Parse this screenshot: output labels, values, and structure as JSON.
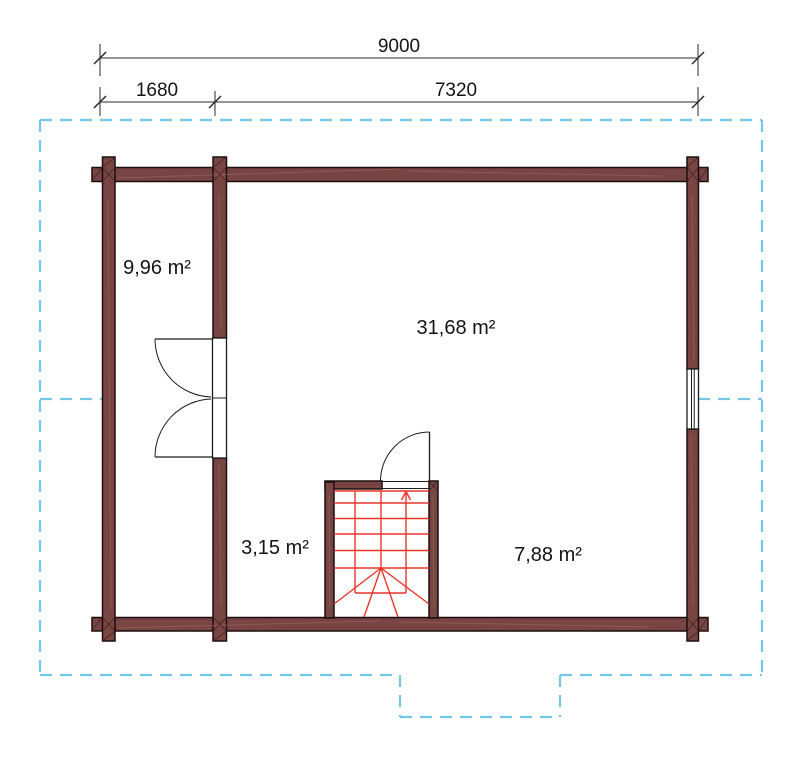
{
  "dimensions": {
    "total": "9000",
    "segment_left": "1680",
    "segment_right": "7320"
  },
  "rooms": [
    {
      "id": "room-left",
      "label": "9,96 m²"
    },
    {
      "id": "room-main",
      "label": "31,68 m²"
    },
    {
      "id": "room-hall",
      "label": "3,15 m²"
    },
    {
      "id": "room-right",
      "label": "7,88 m²"
    }
  ],
  "colors": {
    "background": "#ffffff",
    "wall-fill": "#794444",
    "wall-outline": "#1c0e0e",
    "wall-grain": "#9a6a5e",
    "stair-line": "#e8362a",
    "roof-outline": "#74c8e6",
    "dim-line": "#2b2b2b",
    "door-window": "#1c1c1c",
    "text": "#141414"
  }
}
